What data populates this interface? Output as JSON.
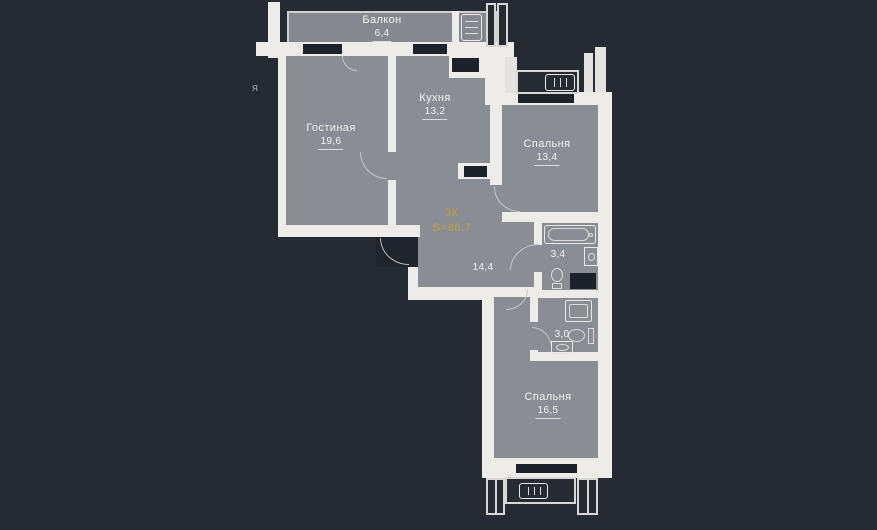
{
  "floorplan": {
    "background": "#262a33",
    "colors": {
      "wall": "#edece8",
      "room_fill": "#8a8d93",
      "balcony_fill": "#85888e",
      "outline": "#d8d7d3",
      "window": "#1d212a",
      "accent_gold": "#c2a044",
      "label_text": "#f3f2ef"
    },
    "summary": {
      "type_label": "3К",
      "area_label": "S=86,7"
    },
    "rooms": {
      "balcony": {
        "name": "Балкон",
        "area": "6,4"
      },
      "living": {
        "name": "Гостиная",
        "area": "19,6"
      },
      "kitchen": {
        "name": "Кухня",
        "area": "13,2"
      },
      "bedroom1": {
        "name": "Спальня",
        "area": "13,4"
      },
      "hallway": {
        "area": "14,4"
      },
      "bathroom": {
        "area": "3,4"
      },
      "wc": {
        "area": "3,0"
      },
      "bedroom2": {
        "name": "Спальня",
        "area": "16,5"
      }
    },
    "edge_text": "я",
    "fixtures": [
      "bathtub",
      "toilet",
      "sink",
      "shower",
      "air-conditioner"
    ]
  }
}
